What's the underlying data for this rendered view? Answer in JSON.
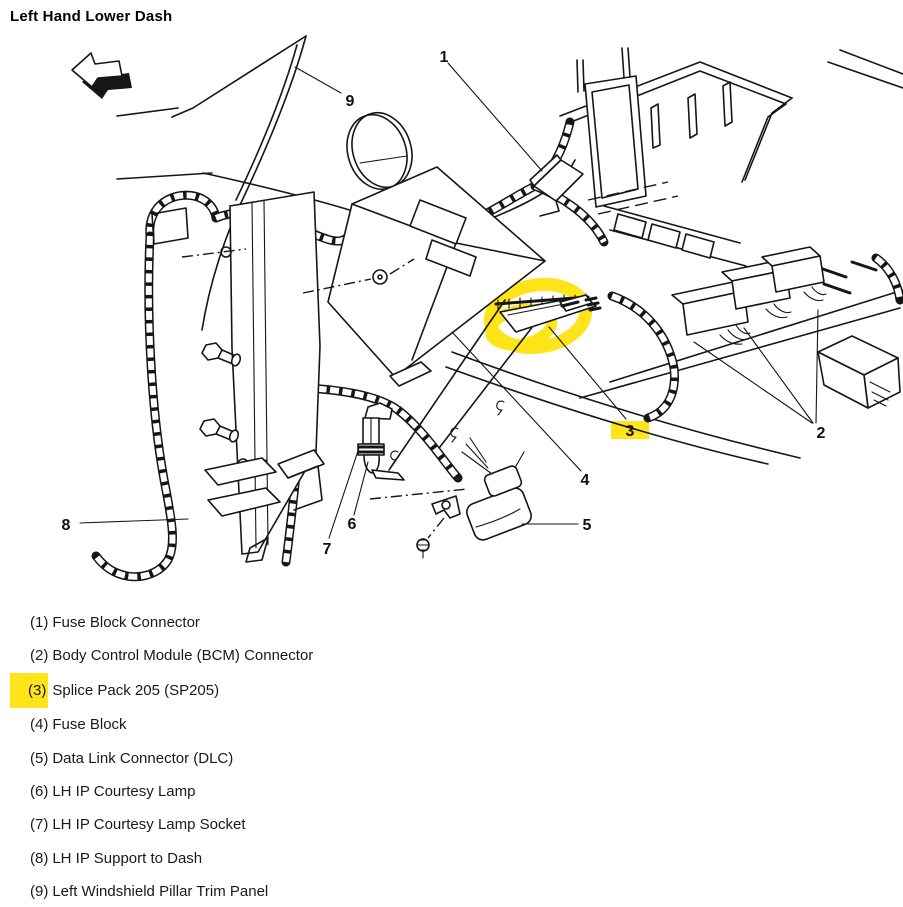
{
  "title": "Left Hand Lower Dash",
  "colors": {
    "highlight": "#ffe41a",
    "line": "#161616"
  },
  "callouts": [
    {
      "num": "1",
      "highlighted": false
    },
    {
      "num": "2",
      "highlighted": false
    },
    {
      "num": "3",
      "highlighted": true
    },
    {
      "num": "4",
      "highlighted": false
    },
    {
      "num": "5",
      "highlighted": false
    },
    {
      "num": "6",
      "highlighted": false
    },
    {
      "num": "7",
      "highlighted": false
    },
    {
      "num": "8",
      "highlighted": false
    },
    {
      "num": "9",
      "highlighted": false
    }
  ],
  "legend": {
    "items": [
      {
        "num": "(1)",
        "label": "Fuse Block Connector",
        "highlighted": false
      },
      {
        "num": "(2)",
        "label": "Body Control Module (BCM) Connector",
        "highlighted": false
      },
      {
        "num": "(3)",
        "label": "Splice Pack 205 (SP205)",
        "highlighted": true
      },
      {
        "num": "(4)",
        "label": "Fuse Block",
        "highlighted": false
      },
      {
        "num": "(5)",
        "label": "Data Link Connector (DLC)",
        "highlighted": false
      },
      {
        "num": "(6)",
        "label": "LH IP Courtesy Lamp",
        "highlighted": false
      },
      {
        "num": "(7)",
        "label": "LH IP Courtesy Lamp Socket",
        "highlighted": false
      },
      {
        "num": "(8)",
        "label": "LH IP Support to Dash",
        "highlighted": false
      },
      {
        "num": "(9)",
        "label": "Left Windshield Pillar Trim Panel",
        "highlighted": false
      }
    ]
  }
}
